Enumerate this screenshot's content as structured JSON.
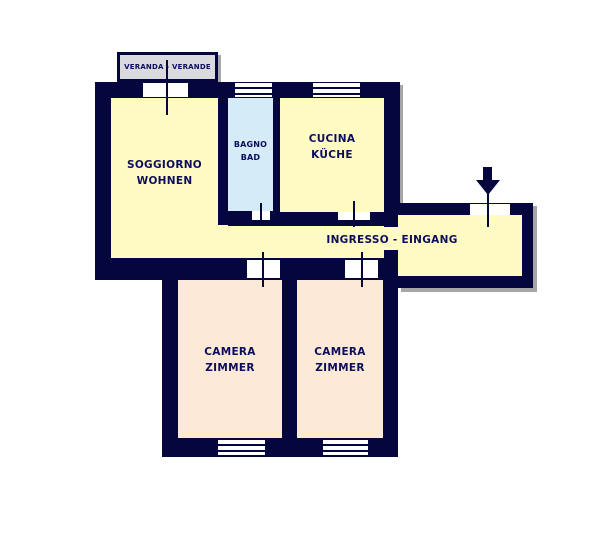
{
  "title": "Apartment floor plan (Italian / German)",
  "colors": {
    "wall": "#06063f",
    "room_yellow": "#fffbc2",
    "room_blue": "#d5ecf8",
    "room_peach": "#fcead7",
    "veranda_fill": "#d9d9de",
    "shadow": "#a6a6a6",
    "label": "#0d0d5e"
  },
  "rooms": {
    "veranda": {
      "label": "VERANDA - VERANDE"
    },
    "soggiorno": {
      "label_line1": "SOGGIORNO",
      "label_line2": "WOHNEN"
    },
    "bagno": {
      "label_line1": "BAGNO",
      "label_line2": "BAD"
    },
    "cucina": {
      "label_line1": "CUCINA",
      "label_line2": "KÜCHE"
    },
    "ingresso": {
      "label": "INGRESSO - EINGANG"
    },
    "camera1": {
      "label_line1": "CAMERA",
      "label_line2": "ZIMMER"
    },
    "camera2": {
      "label_line1": "CAMERA",
      "label_line2": "ZIMMER"
    }
  },
  "icons": {
    "entrance_arrow": "down-arrow"
  }
}
